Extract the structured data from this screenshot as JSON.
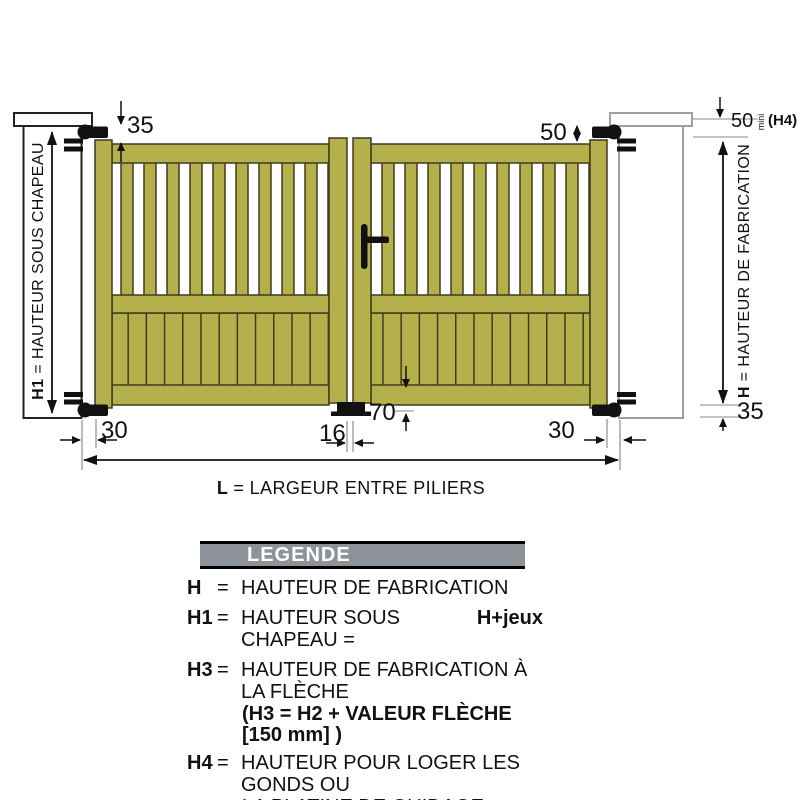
{
  "diagram": {
    "annotations": {
      "top_left_offset": "35",
      "top_right_offset": "50",
      "hinge_height_value": "50",
      "hinge_height_unit": "mini",
      "hinge_height_ref": "(H4)",
      "bottom_clearance": "35",
      "bottom_rail_height": "70",
      "left_pillar_gap": "30",
      "center_gap": "16",
      "right_pillar_gap": "30",
      "h1_term": "H1",
      "h1_text": "= HAUTEUR SOUS CHAPEAU",
      "h_term": "H",
      "h_text": "= HAUTEUR DE FABRICATION",
      "l_term": "L",
      "l_text": "= LARGEUR ENTRE PILIERS"
    },
    "colors": {
      "gate_fill": "#b4b04c",
      "gate_outline": "#3e3b1e",
      "hardware": "#111111",
      "pillar_outline_left": "#222222",
      "pillar_outline_right": "#9aa0a4",
      "legend_header_bg": "#8d9399"
    }
  },
  "legend": {
    "title": "LEGENDE",
    "entries": [
      {
        "term": "H",
        "eq": "=",
        "text": "HAUTEUR DE FABRICATION"
      },
      {
        "term": "H1",
        "eq": "=",
        "text": "HAUTEUR SOUS CHAPEAU =",
        "bold_suffix": "H+jeux"
      },
      {
        "term": "H3",
        "eq": "=",
        "text": "HAUTEUR DE FABRICATION À LA FLÈCHE",
        "subline_bold": "(H3 = H2 + VALEUR FLÈCHE [150 mm] )"
      },
      {
        "term": "H4",
        "eq": "=",
        "text": "HAUTEUR POUR LOGER LES GONDS OU",
        "subline": "LA PLATINE DE GUIDAGE"
      }
    ]
  }
}
